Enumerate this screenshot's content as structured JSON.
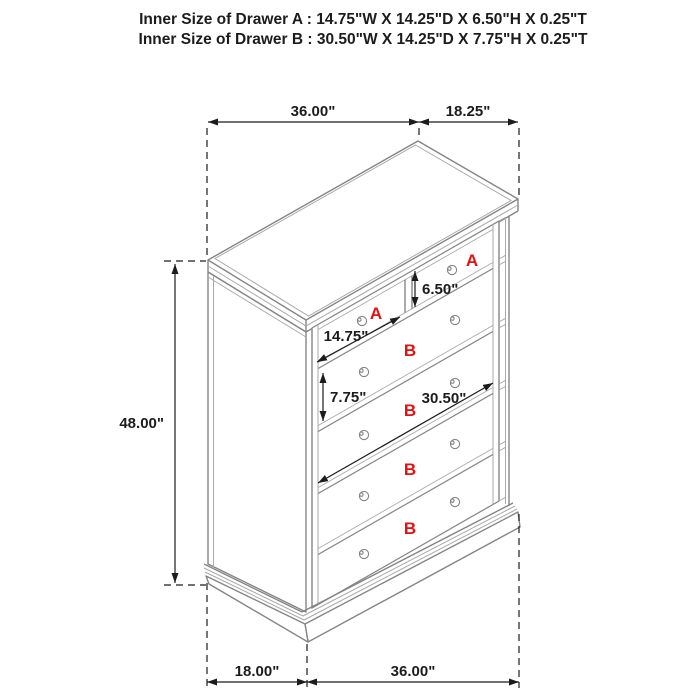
{
  "header": {
    "line1": "Inner Size of Drawer A : 14.75\"W X 14.25\"D X 6.50\"H X 0.25\"T",
    "line2": "Inner Size of Drawer B : 30.50\"W X 14.25\"D X 7.75\"H X 0.25\"T"
  },
  "dimensions": {
    "top_width": "36.00\"",
    "top_depth": "18.25\"",
    "height": "48.00\"",
    "drawer_a_height": "6.50\"",
    "drawer_a_width": "14.75\"",
    "drawer_b_height": "7.75\"",
    "drawer_b_width": "30.50\"",
    "bottom_depth": "18.00\"",
    "bottom_width": "36.00\""
  },
  "drawer_labels": {
    "a": "A",
    "b": "B"
  },
  "colors": {
    "line_gray": "#858585",
    "line_light": "#a9a9a9",
    "dim_black": "#1c1c1c",
    "label_red": "#e11212",
    "background": "#ffffff"
  }
}
